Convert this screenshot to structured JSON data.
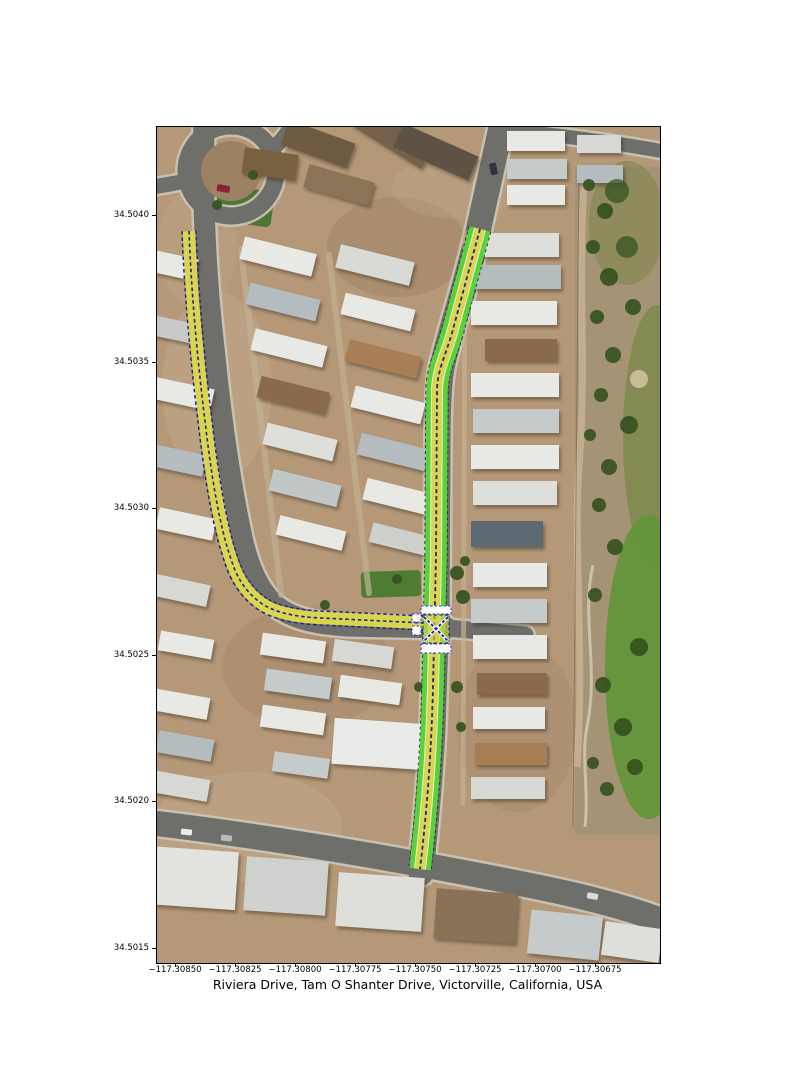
{
  "figure": {
    "title": "Riviera Drive, Tam O Shanter Drive, Victorville, California, USA",
    "background_color": "#ffffff"
  },
  "axes": {
    "x_tick_labels": [
      "−117.30850",
      "−117.30825",
      "−117.30800",
      "−117.30775",
      "−117.30750",
      "−117.30725",
      "−117.30700",
      "−117.30675"
    ],
    "y_tick_labels": [
      "34.5040",
      "34.5035",
      "34.5030",
      "34.5025",
      "34.5020",
      "34.5015"
    ],
    "x_range_approx": [
      "−117.30858",
      "−117.30648"
    ],
    "y_range_approx": [
      "34.50145",
      "34.50430"
    ]
  },
  "highlighted_roads": [
    "Riviera Drive",
    "Tam O Shanter Drive"
  ],
  "overlay_colors": {
    "lane_yellow": "#d9d54e",
    "shoulder_green": "#57d23c",
    "divider_navy": "#232387",
    "crosswalk_white": "#fafafa",
    "crosswalk_outline_blue": "#3a3acc"
  },
  "basemap": {
    "type": "satellite aerial imagery",
    "scene": "mobile-home neighborhood with golf-course greenbelt on east side"
  }
}
